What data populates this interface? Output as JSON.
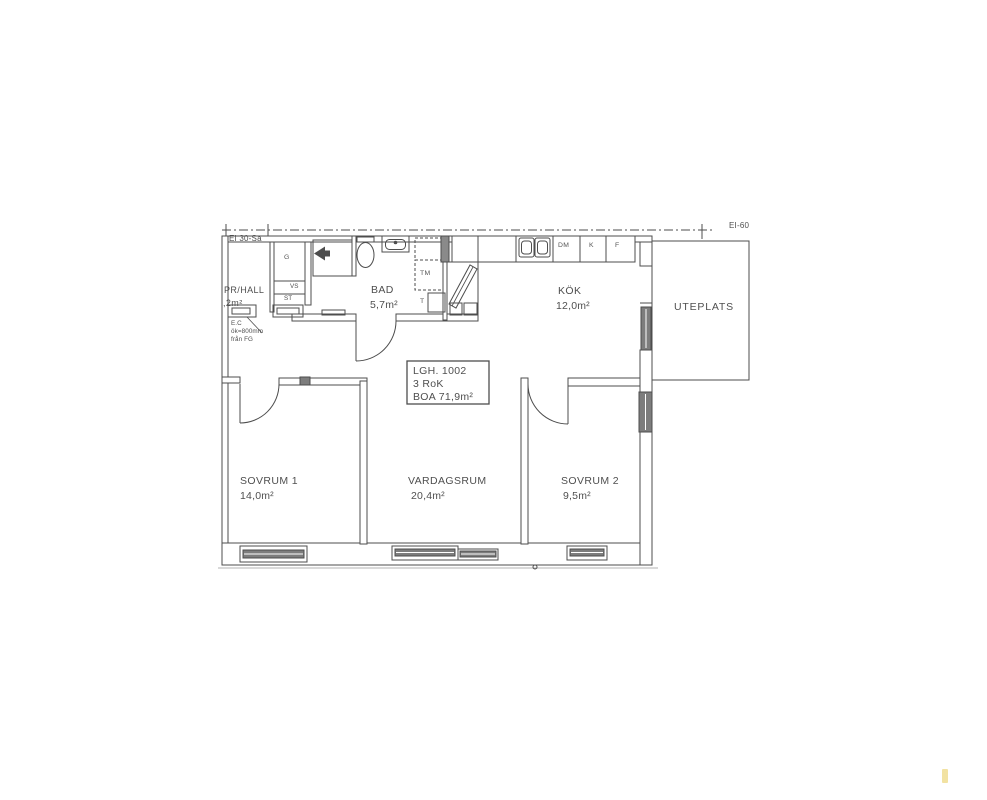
{
  "drawing": {
    "title_box": {
      "line1": "LGH. 1002",
      "line2": "3 RoK",
      "line3": "BOA 71,9m²"
    },
    "rooms": [
      {
        "id": "hall",
        "name": "PR/HALL",
        "area": ",2m²"
      },
      {
        "id": "bad",
        "name": "BAD",
        "area": "5,7m²"
      },
      {
        "id": "kok",
        "name": "KÖK",
        "area": "12,0m²"
      },
      {
        "id": "uteplats",
        "name": "UTEPLATS",
        "area": ""
      },
      {
        "id": "sovrum1",
        "name": "SOVRUM 1",
        "area": "14,0m²"
      },
      {
        "id": "vardagsrum",
        "name": "VARDAGSRUM",
        "area": "20,4m²"
      },
      {
        "id": "sovrum2",
        "name": "SOVRUM 2",
        "area": "9,5m²"
      }
    ],
    "fixtures": {
      "garderob": "G",
      "vs": "VS",
      "stad": "ST",
      "tvattmaskin": "TM",
      "torktumlare": "T",
      "diskmaskin": "DM",
      "kyl": "K",
      "frys": "F"
    },
    "annotations": {
      "fire_class_left": "EI 30-Sa",
      "fire_class_right": "EI-60",
      "ec_line1": "E.C",
      "ec_line2": "ök=800mm",
      "ec_line3": "från FG"
    },
    "colors": {
      "line": "#4d4d4d",
      "text": "#4f4f4f",
      "window_fill": "#7d7d7d",
      "accent_mark": "#f2e2a2"
    }
  }
}
